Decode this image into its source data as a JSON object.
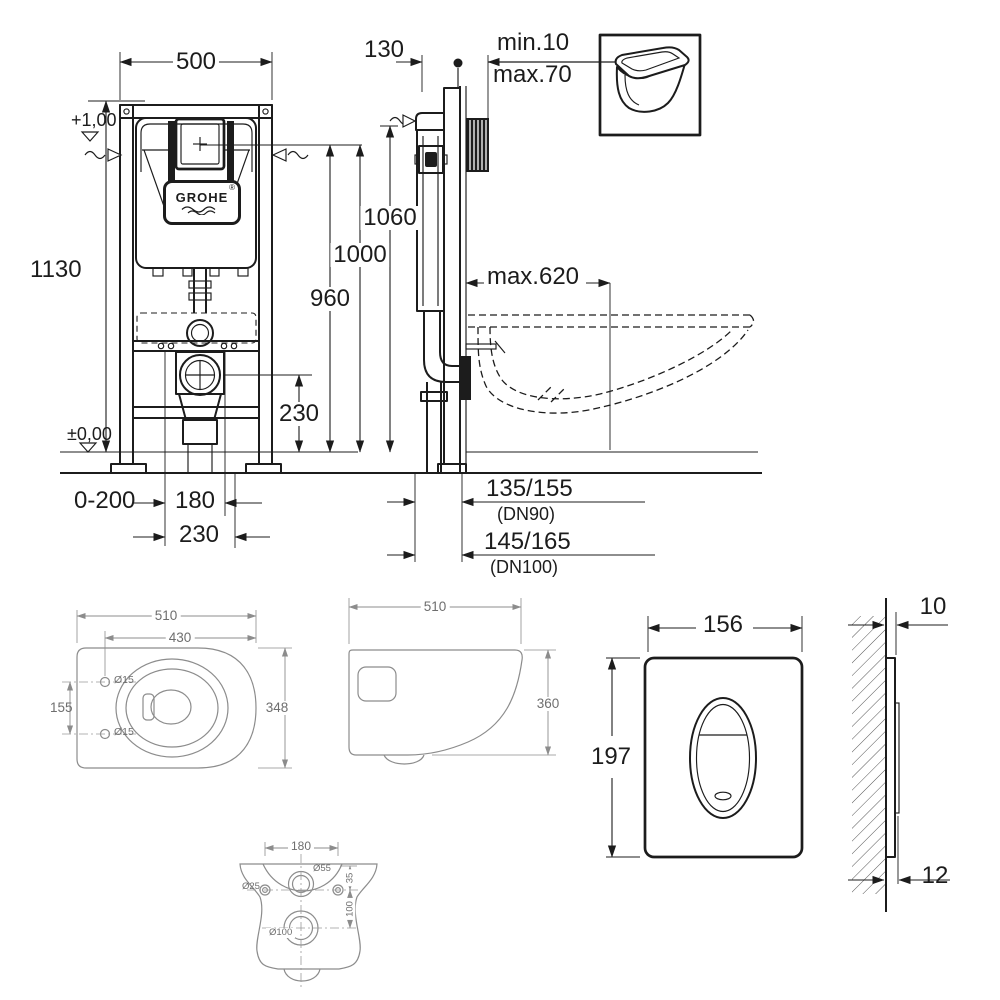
{
  "colors": {
    "ink": "#1c1c1c",
    "secondary_line": "#8c8c8c",
    "secondary_text": "#6e6e6e"
  },
  "product": {
    "brand": "GROHE",
    "logo_mark": "®"
  },
  "frame_front_view": {
    "width": "500",
    "height": "1130",
    "upper_level": "+1,00",
    "zero_level": "±0,00",
    "floor_buildup": "0-200",
    "bolt_spacing": "180",
    "drain_offset": "230",
    "drain_height": "230",
    "actuation_height": "960",
    "level_height": "1000"
  },
  "frame_side_view": {
    "depth": "130",
    "wall_thickness_min": "min.10",
    "wall_thickness_max": "max.70",
    "height": "1060",
    "bowl_projection": "max.620",
    "drain_dn90": "135/155",
    "drain_dn90_note": "(DN90)",
    "drain_dn100": "145/165",
    "drain_dn100_note": "(DN100)"
  },
  "bowl_top_view": {
    "depth": "510",
    "rim_offset": "430",
    "width": "348",
    "hole_spacing": "155",
    "hole_diameter_top": "Ø15",
    "hole_diameter_bottom": "Ø15"
  },
  "bowl_side_view": {
    "depth": "510",
    "height": "360"
  },
  "bowl_rear_view": {
    "hole_spacing": "180",
    "inlet_diameter": "Ø55",
    "fixing_diameter": "Ø25",
    "outlet_diameter": "Ø100",
    "inlet_offset": "35",
    "outlet_offset": "100"
  },
  "plate_front_view": {
    "width": "156",
    "height": "197"
  },
  "plate_side_view": {
    "protrusion": "10",
    "thickness": "12"
  }
}
